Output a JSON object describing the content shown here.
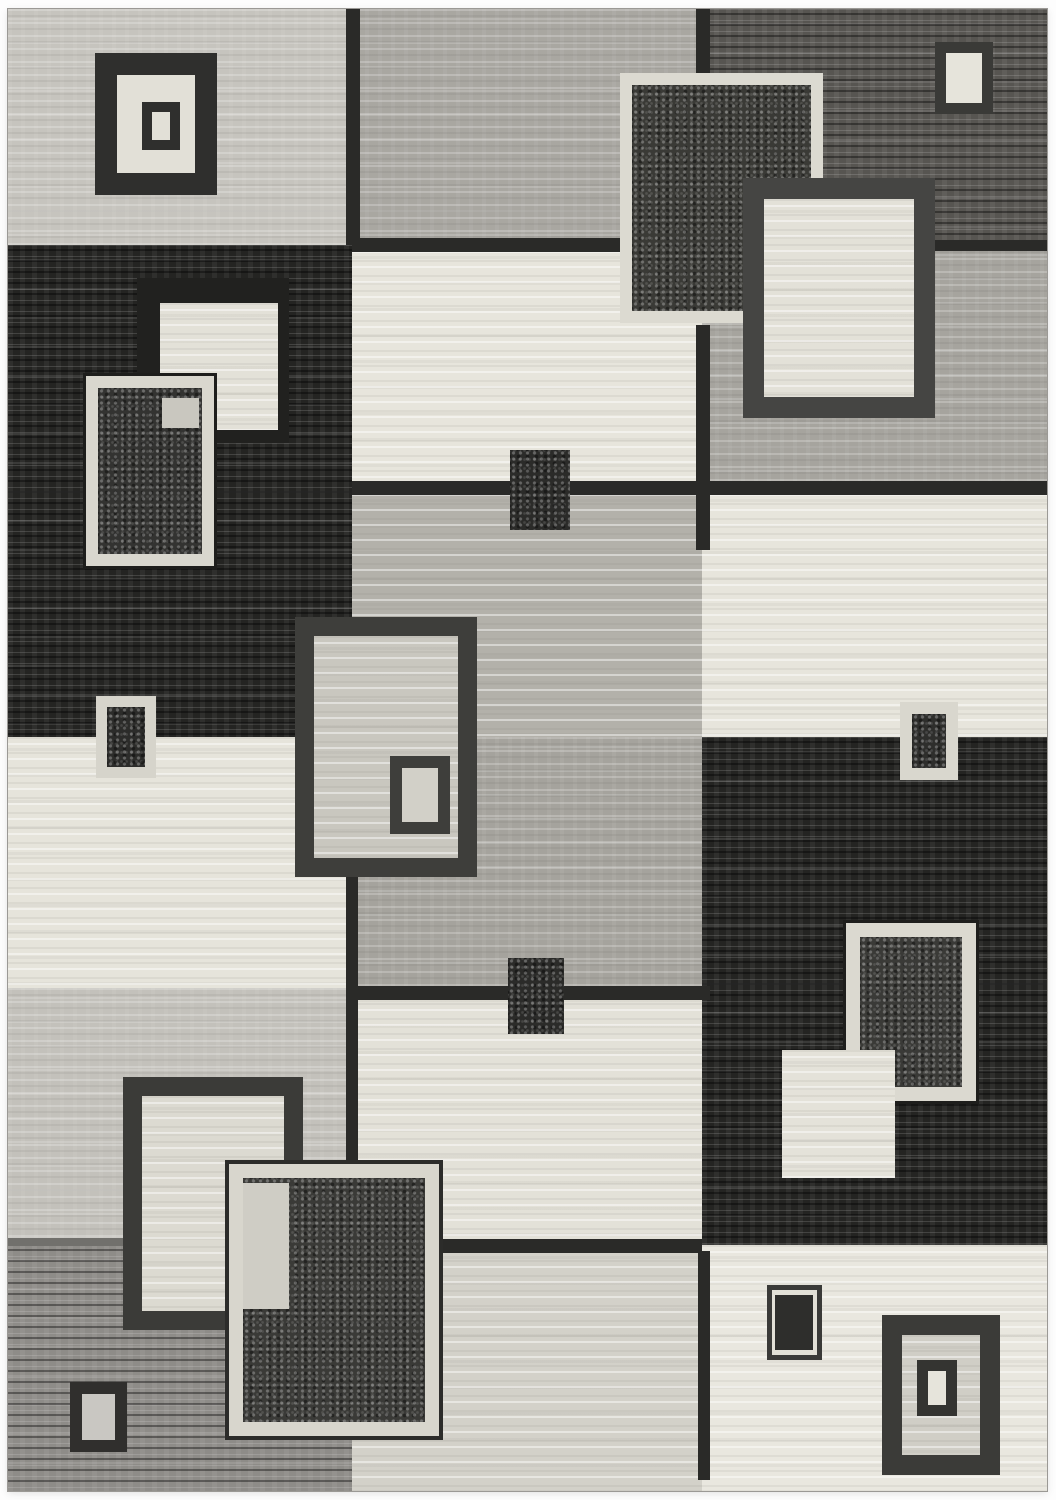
{
  "alt": "Modern abstract area rug photographed on white: patchwork of light gray, medium gray, black and cream blocks with overlapping concentric square and rectangle motifs",
  "canvas": {
    "width": 1056,
    "height": 1500
  },
  "rug": {
    "x": 8,
    "y": 9,
    "width": 1039,
    "height": 1482
  },
  "palette": {
    "cream": "#e7e5dc",
    "light_gray": "#c6c4be",
    "medium_gray": "#a7a5a0",
    "dark_gray": "#575551",
    "black": "#242422",
    "charcoal": "#3a3a37",
    "cream_border": "#d9d7ce",
    "line_dark": "#2a2a28"
  },
  "shapes": [
    {
      "n": "block-top-left-light",
      "x": 8,
      "y": 9,
      "w": 344,
      "h": 236,
      "bg": "#c6c4be",
      "tx": "streak-light"
    },
    {
      "n": "block-top-middle-gray",
      "x": 352,
      "y": 9,
      "w": 350,
      "h": 236,
      "bg": "#a9a7a1",
      "tx": "streak-light"
    },
    {
      "n": "block-top-right-darkgray",
      "x": 702,
      "y": 9,
      "w": 345,
      "h": 236,
      "bg": "#575551",
      "tx": "streak-dark"
    },
    {
      "n": "block-left-black",
      "x": 8,
      "y": 245,
      "w": 344,
      "h": 492,
      "bg": "#242422",
      "tx": "streak-dark"
    },
    {
      "n": "block-middle-cream-upper",
      "x": 352,
      "y": 245,
      "w": 350,
      "h": 243,
      "bg": "#e7e5dc",
      "tx": "streak-cream"
    },
    {
      "n": "block-right-gray",
      "x": 702,
      "y": 245,
      "w": 345,
      "h": 243,
      "bg": "#a6a49e",
      "tx": "streak-light"
    },
    {
      "n": "block-middle-lightgray",
      "x": 352,
      "y": 488,
      "w": 350,
      "h": 249,
      "bg": "#b3b1aa",
      "tx": "streak-cream"
    },
    {
      "n": "block-right-cream",
      "x": 702,
      "y": 488,
      "w": 345,
      "h": 249,
      "bg": "#e7e5dc",
      "tx": "streak-cream"
    },
    {
      "n": "block-left-cream",
      "x": 8,
      "y": 737,
      "w": 344,
      "h": 251,
      "bg": "#e6e4db",
      "tx": "streak-cream"
    },
    {
      "n": "block-middle-gray-mid",
      "x": 352,
      "y": 737,
      "w": 350,
      "h": 251,
      "bg": "#a5a39d",
      "tx": "streak-light"
    },
    {
      "n": "block-right-black",
      "x": 702,
      "y": 737,
      "w": 345,
      "h": 508,
      "bg": "#242422",
      "tx": "streak-dark"
    },
    {
      "n": "block-left-lightgray",
      "x": 8,
      "y": 988,
      "w": 344,
      "h": 257,
      "bg": "#c3c1bb",
      "tx": "streak-light"
    },
    {
      "n": "block-middle-cream-mid",
      "x": 352,
      "y": 988,
      "w": 350,
      "h": 257,
      "bg": "#e3e1d8",
      "tx": "streak-cream"
    },
    {
      "n": "block-left-bottom-gray",
      "x": 8,
      "y": 1245,
      "w": 344,
      "h": 246,
      "bg": "#8e8c88",
      "tx": "streak-dark"
    },
    {
      "n": "block-middle-cream-bottom",
      "x": 352,
      "y": 1245,
      "w": 350,
      "h": 246,
      "bg": "#d3d1c9",
      "tx": "streak-cream"
    },
    {
      "n": "block-right-bottom-cream",
      "x": 702,
      "y": 1245,
      "w": 345,
      "h": 246,
      "bg": "#e9e7df",
      "tx": "streak-cream"
    },
    {
      "n": "divider-top-left-vertical",
      "x": 346,
      "y": 9,
      "w": 14,
      "h": 236,
      "bg": "#2a2a28"
    },
    {
      "n": "divider-top-right-vertical",
      "x": 696,
      "y": 9,
      "w": 14,
      "h": 64,
      "bg": "#2a2a28"
    },
    {
      "n": "divider-row1-middle",
      "x": 352,
      "y": 238,
      "w": 270,
      "h": 14,
      "bg": "#2a2a28"
    },
    {
      "n": "divider-row1-right",
      "x": 935,
      "y": 240,
      "w": 112,
      "h": 11,
      "bg": "#2a2a28"
    },
    {
      "n": "divider-row2-horizontal",
      "x": 352,
      "y": 481,
      "w": 695,
      "h": 14,
      "bg": "#2a2a28"
    },
    {
      "n": "divider-mid-right-vertical",
      "x": 696,
      "y": 325,
      "w": 14,
      "h": 225,
      "bg": "#2a2a28"
    },
    {
      "n": "divider-row3-horizontal",
      "x": 352,
      "y": 986,
      "w": 358,
      "h": 14,
      "bg": "#2a2a28"
    },
    {
      "n": "divider-mid-left-vertical",
      "x": 346,
      "y": 877,
      "w": 12,
      "h": 288,
      "bg": "#2a2a28"
    },
    {
      "n": "divider-row4-horizontal",
      "x": 440,
      "y": 1239,
      "w": 262,
      "h": 14,
      "bg": "#2a2a28"
    },
    {
      "n": "divider-bottom-vertical",
      "x": 698,
      "y": 1251,
      "w": 12,
      "h": 229,
      "bg": "#2a2a28"
    },
    {
      "n": "divider-left-row4-subtle",
      "x": 8,
      "y": 1238,
      "w": 338,
      "h": 8,
      "bg": "#71706c"
    },
    {
      "n": "motif-topleft-square",
      "x": 95,
      "y": 53,
      "w": 122,
      "h": 142,
      "bg": "#e2e0d7",
      "bc": "#2f2f2d",
      "bw": 22
    },
    {
      "n": "motif-topleft-square-inner",
      "x": 142,
      "y": 102,
      "w": 38,
      "h": 48,
      "bg": "#e2e0d7",
      "bc": "#2f2f2d",
      "bw": 10
    },
    {
      "n": "motif-leftblack-halo",
      "x": 137,
      "y": 278,
      "w": 152,
      "h": 165,
      "bg": "#21211f"
    },
    {
      "n": "motif-leftblack-cream-rect",
      "x": 160,
      "y": 303,
      "w": 118,
      "h": 127,
      "bg": "#e3e1d8",
      "tx": "streak-cream"
    },
    {
      "n": "motif-leftblack-bordered-rect",
      "x": 85,
      "y": 375,
      "w": 130,
      "h": 192,
      "bg": "#333331",
      "bc": "#d9d7ce",
      "bw": 13,
      "tx": "speckle",
      "oc": "#1e1e1c",
      "ow": 3
    },
    {
      "n": "motif-leftblack-overlap-patch",
      "x": 162,
      "y": 398,
      "w": 37,
      "h": 30,
      "bg": "#c9c7bf"
    },
    {
      "n": "motif-left-small-square",
      "x": 96,
      "y": 696,
      "w": 60,
      "h": 82,
      "bg": "#2c2c2a",
      "bc": "#d6d4cb",
      "bw": 11,
      "tx": "speckle"
    },
    {
      "n": "motif-topright-small",
      "x": 935,
      "y": 42,
      "w": 58,
      "h": 72,
      "bg": "#e6e4db",
      "bc": "#3a3a37",
      "bw": 11
    },
    {
      "n": "motif-topright-black-square",
      "x": 620,
      "y": 73,
      "w": 203,
      "h": 250,
      "bg": "#3a3a36",
      "bc": "#dcdad1",
      "bw": 12,
      "tx": "speckle"
    },
    {
      "n": "motif-topright-cream-rect",
      "x": 743,
      "y": 178,
      "w": 192,
      "h": 240,
      "bg": "#e3e1d8",
      "bc": "#454543",
      "bw": 21,
      "tx": "streak-cream"
    },
    {
      "n": "motif-middle-small-dark-upper",
      "x": 510,
      "y": 450,
      "w": 60,
      "h": 80,
      "bg": "#2b2b29",
      "tx": "speckle"
    },
    {
      "n": "motif-center-square",
      "x": 295,
      "y": 617,
      "w": 182,
      "h": 260,
      "bg": "#c9c7bf",
      "bc": "#3e3e3b",
      "bw": 19,
      "tx": "streak-cream"
    },
    {
      "n": "motif-center-square-inner",
      "x": 390,
      "y": 756,
      "w": 60,
      "h": 78,
      "bg": "#d2d0c8",
      "bc": "#3e3e3b",
      "bw": 12
    },
    {
      "n": "motif-right-small-square",
      "x": 900,
      "y": 702,
      "w": 58,
      "h": 78,
      "bg": "#2e2e2c",
      "bc": "#d9d7ce",
      "bw": 12,
      "tx": "speckle"
    },
    {
      "n": "motif-middle-small-dark-lower",
      "x": 508,
      "y": 958,
      "w": 56,
      "h": 76,
      "bg": "#2b2b29",
      "tx": "speckle"
    },
    {
      "n": "motif-rightblack-bordered-rect",
      "x": 845,
      "y": 922,
      "w": 132,
      "h": 180,
      "bg": "#3a3a37",
      "bc": "#dbd9d0",
      "bw": 15,
      "tx": "speckle",
      "oc": "#1e1e1c",
      "ow": 3
    },
    {
      "n": "motif-rightblack-cream-square",
      "x": 782,
      "y": 1050,
      "w": 113,
      "h": 128,
      "bg": "#e4e2d9",
      "tx": "streak-cream"
    },
    {
      "n": "motif-bottomleft-dark-rect",
      "x": 123,
      "y": 1077,
      "w": 180,
      "h": 253,
      "bg": "#dcdad1",
      "bc": "#3b3b38",
      "bw": 19,
      "tx": "streak-cream"
    },
    {
      "n": "motif-bottomleft-cream-rect",
      "x": 228,
      "y": 1163,
      "w": 212,
      "h": 274,
      "bg": "#3a3a37",
      "bc": "#d8d6cd",
      "bw": 15,
      "tx": "speckle",
      "oc": "#2c2c2a",
      "ow": 4
    },
    {
      "n": "motif-bottomleft-overlap-patch",
      "x": 243,
      "y": 1183,
      "w": 46,
      "h": 126,
      "bg": "#cfcdc5"
    },
    {
      "n": "motif-bottomright-small",
      "x": 767,
      "y": 1285,
      "w": 55,
      "h": 75,
      "bg": "#e2e0d7",
      "bc": "#3a3a38",
      "bw": 5
    },
    {
      "n": "motif-bottomright-small-inner",
      "x": 775,
      "y": 1295,
      "w": 38,
      "h": 55,
      "bg": "#2e2e2c"
    },
    {
      "n": "motif-bottomright-square",
      "x": 882,
      "y": 1315,
      "w": 118,
      "h": 160,
      "bg": "#d0cec6",
      "bc": "#3b3b38",
      "bw": 20,
      "tx": "streak-cream"
    },
    {
      "n": "motif-bottomright-square-inner",
      "x": 917,
      "y": 1360,
      "w": 40,
      "h": 56,
      "bg": "#e6e4db",
      "bc": "#343431",
      "bw": 11
    },
    {
      "n": "motif-bottomleft-corner-square",
      "x": 70,
      "y": 1382,
      "w": 57,
      "h": 70,
      "bg": "#c9c7c2",
      "bc": "#302f2d",
      "bw": 12
    }
  ]
}
